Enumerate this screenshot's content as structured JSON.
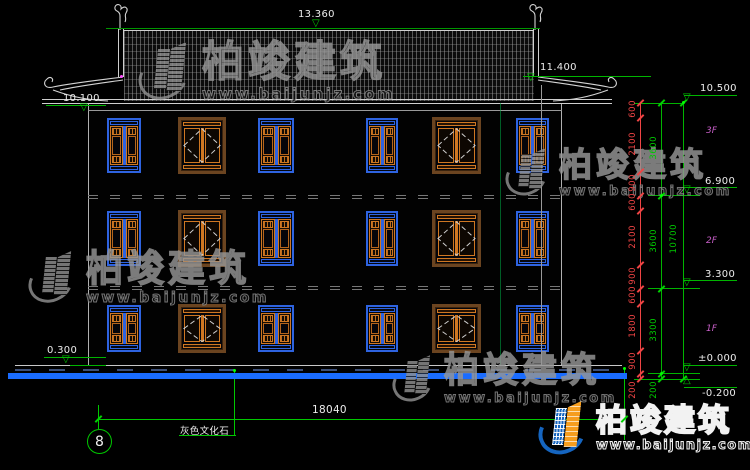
{
  "brand": {
    "name": "柏竣建筑",
    "site": "www.baijunjz.com"
  },
  "colors": {
    "dim_green": "#00c800",
    "dim_red": "#ef4444",
    "ground_blue": "#1a6cff",
    "window_blue": "#2e63e0",
    "window_orange": "#cf7722",
    "floor_label_magenta": "#c95fc9"
  },
  "annotations": {
    "ridge_elev": "13.360",
    "right_eave_elev": "11.400",
    "left_eave_elev": "10.100",
    "parapet_elev": "10.500",
    "floor3_elev": "6.900",
    "floor2_elev": "3.300",
    "ground_elev": "±0.000",
    "below_ground_elev": "-0.200",
    "plinth_elev": "0.300",
    "floor3_label": "3F",
    "floor2_label": "2F",
    "floor1_label": "1F",
    "overall_width": "18040",
    "material_note": "灰色文化石",
    "grid_bubble": "8"
  },
  "dim_chain": {
    "segments": [
      "600",
      "2100",
      "900",
      "600",
      "2100",
      "900",
      "600",
      "1800",
      "900",
      "200"
    ],
    "floors": [
      "3600",
      "3600",
      "3300",
      "200"
    ],
    "total": "10700"
  }
}
